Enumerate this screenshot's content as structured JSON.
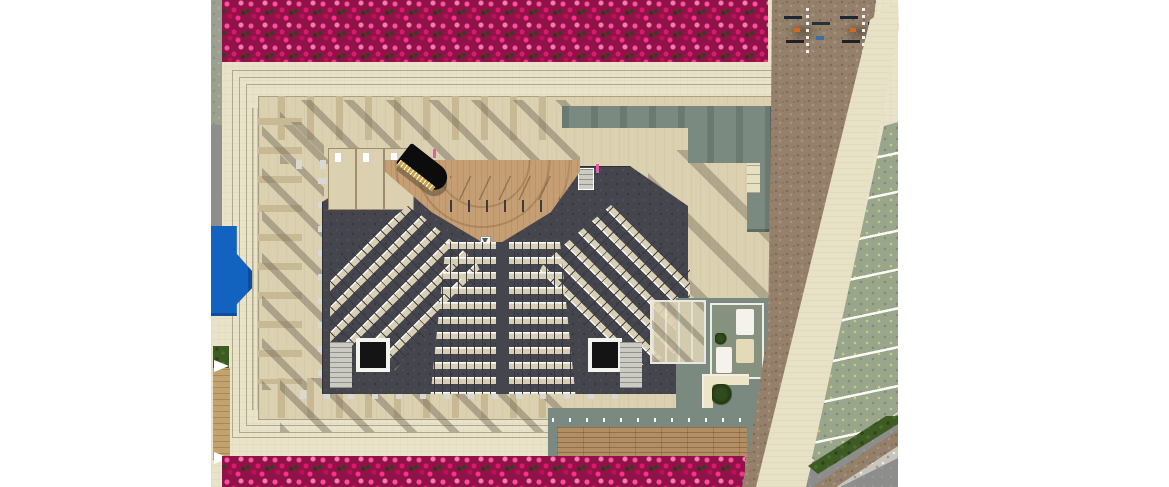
{
  "scene": {
    "title": "Rendered top-down architectural site plan of an open-air concert auditorium",
    "type": "3d-rendered-site-plan",
    "contains_text": false
  },
  "regions": {
    "flower_hedge_top": "Dense pink bougainvillea hedge along the north edge of the plaza",
    "flower_hedge_bottom": "Pink bougainvillea hedge along the south edge of the plaza",
    "plaza": "Cream stone public plaza surrounding the auditorium",
    "auditorium": "Rectangular open-air auditorium with perimeter colonnade of fins casting diagonal shadows",
    "stage": "Wooden thrust stage with grand piano and six music stands",
    "grand_piano": "Black grand piano with gold keyboard edge, placed stage left",
    "seating_left": "Angled seating block, rows rotated toward stage (about 8 rows)",
    "seating_right": "Angled seating block, mirrored (about 8 rows)",
    "seating_center": "Central seating block split by a middle aisle (about 11 rows)",
    "vestibules": "Two dark entry vestibules with white frames at the rear corners",
    "roof_sage": "Sage-green flat roof over backstage rooms at the north-east of the building",
    "annex": "East annex: pergola room, furnished lounge room and a planter courtyard",
    "wood_deck": "Long timber deck with bench supports on the south-east lawn court",
    "pool": "Small blue water feature on the west edge",
    "dirt_path": "Brown decomposed-granite pedestrian band running down the east side",
    "bike_parking": "Two bike racks with parked bicycles on the dirt area, top right",
    "walkway": "Diagonal cream pedestrian walkway between dirt band and parking",
    "parking": "Grass-paver parking stalls with white dividing lines on the far east",
    "service_road": "Grey asphalt road with gravel median at the bottom-right corner",
    "west_strips": "West edge strips: clipped hedge wall, grey road, lawn patch and timber boardwalk"
  },
  "palette": {
    "plaza": "#e8e3c9",
    "travertine": "#dbd1b1",
    "colonnade_fin": "#c8b995",
    "shadow": "#5d5648",
    "auditorium_floor": "#45454e",
    "seat": "#d9d0b4",
    "stage_wood": "#c59f73",
    "sage_green": "#7b8a80",
    "deck_wood": "#b28e64",
    "dirt": "#95816b",
    "parking_grass": "#9aa68c",
    "hedge_dark_green": "#3e5b24",
    "flower_pink": "#e2176e",
    "pool_blue": "#1262bf",
    "asphalt": "#8d8d8b"
  },
  "counts": {
    "seating_blocks": 4,
    "center_rows": 11,
    "side_rows_each": 8,
    "music_stands": 6,
    "grand_pianos": 1,
    "entry_vestibules": 2,
    "bike_rack_groups": 2,
    "parking_stall_dividers": 9,
    "deck_path_lights": 12
  }
}
